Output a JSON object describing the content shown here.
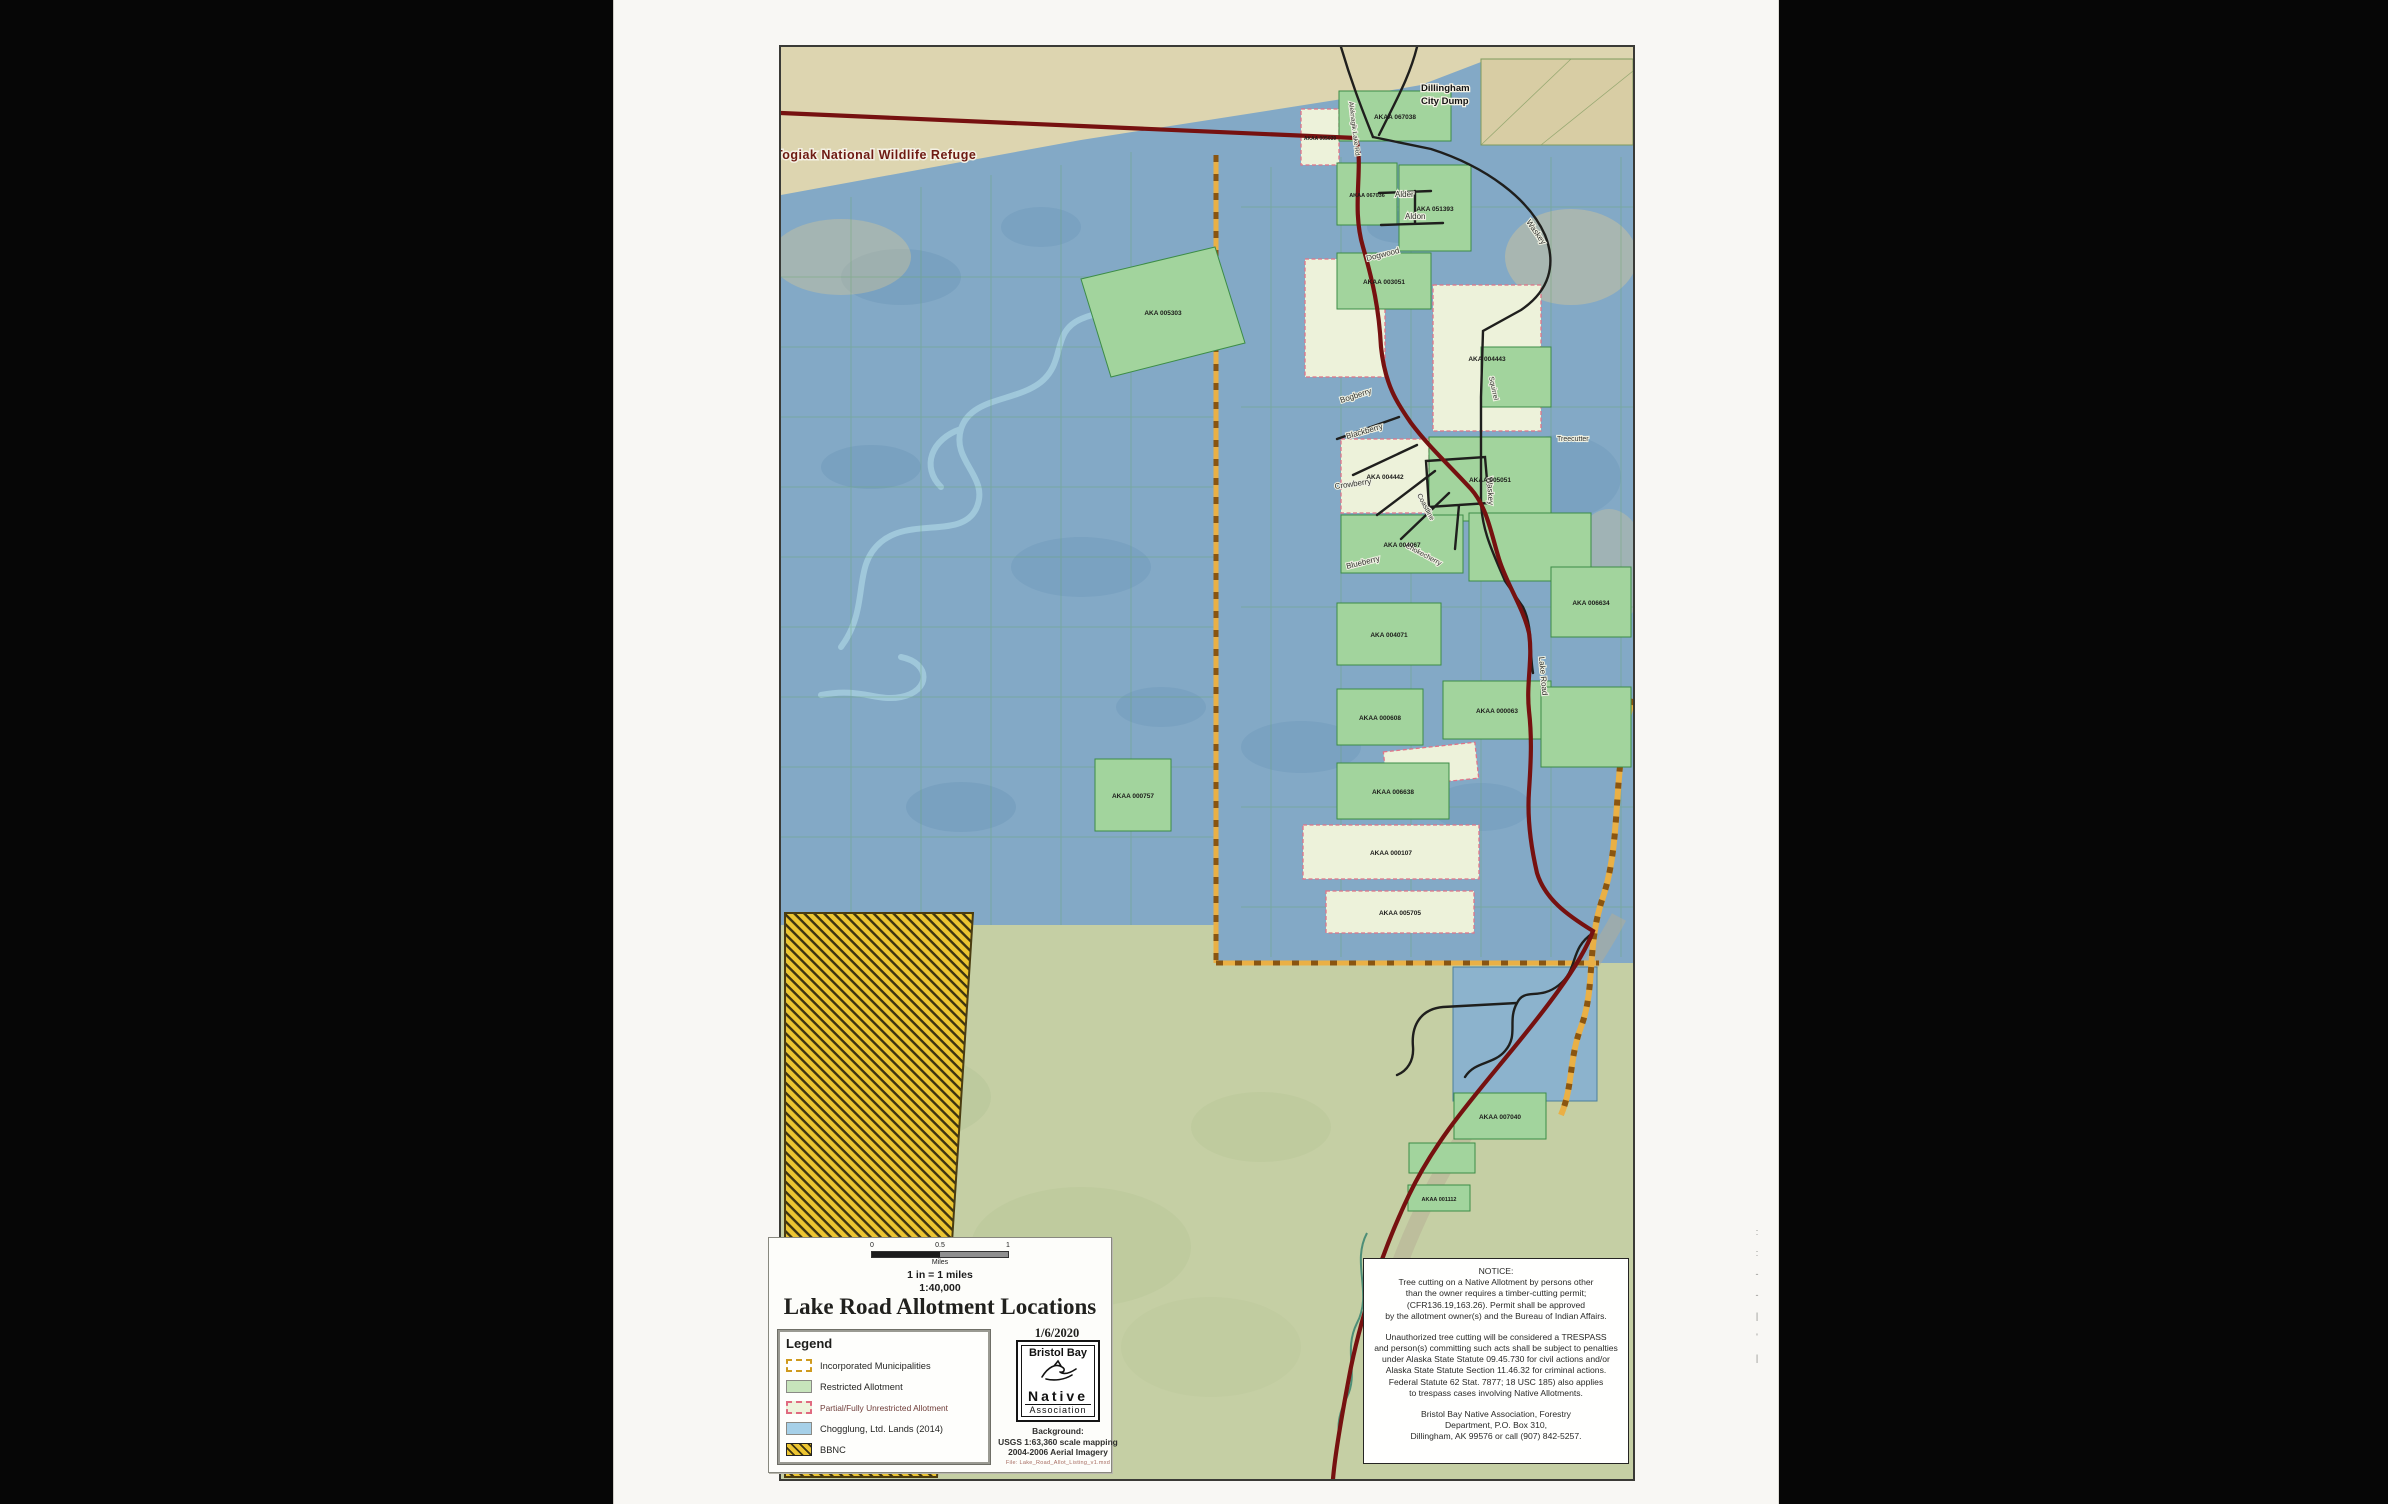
{
  "map": {
    "refuge_label": "Togiak National Wildlife Refuge",
    "dump_label_line1": "Dillingham",
    "dump_label_line2": "City Dump",
    "road_labels": {
      "aleknagik": "Aleknagik Lake Rd",
      "alder": "Alder",
      "aldon": "Aldon",
      "waskey": "Waskey",
      "waskey2": "Waskey",
      "dogwood": "Dogwood",
      "bogberry": "Bogberry",
      "blackberry": "Blackberry",
      "crowberry": "Crowberry",
      "blueberry": "Blueberry",
      "chokecherry": "Chokecherry",
      "coastline": "Coastline",
      "squirrel": "Squirrel",
      "treecutter": "Treecutter",
      "lake_road": "Lake Road"
    },
    "parcels": [
      "AKAA 067038",
      "AKAA 067036",
      "AKA 051393",
      "AKAA 003051",
      "AKA 005303",
      "AKA 004443",
      "AKAA 005051",
      "AKA 004442",
      "AKA 004067",
      "AKA 006634",
      "AKA 004071",
      "AKAA 000608",
      "AKAA 000757",
      "AKAA 006638",
      "AKAA 000107",
      "AKAA 005705",
      "AKAA 007040",
      "AKAA 001112",
      "AKAA 000063",
      "AKAA 005039"
    ],
    "colors": {
      "chogglung_blue": "#83a9c6",
      "restricted_green": "#a2d49d",
      "unrestricted_cream": "#edf2da",
      "bbnc_yellow": "#ecc531",
      "boundary_maroon": "#761110",
      "municipal_orange": "#eab045"
    }
  },
  "title_block": {
    "scale": {
      "ticks": [
        "0",
        "0.5",
        "1"
      ],
      "unit": "Miles",
      "equiv": "1 in = 1 miles",
      "ratio": "1:40,000"
    },
    "title": "Lake Road Allotment Locations",
    "date": "1/6/2020",
    "logo": {
      "line1": "Bristol Bay",
      "line2": "Native",
      "line3": "Association"
    },
    "background_note": "Background:\nUSGS 1:63,360 scale mapping\n2004-2006 Aerial Imagery",
    "file_note": "File: Lake_Road_Allot_Listing_v1.mxd"
  },
  "legend": {
    "heading": "Legend",
    "items": [
      {
        "label": "Incorporated Municipalities"
      },
      {
        "label": "Restricted Allotment"
      },
      {
        "label": "Partial/Fully Unrestricted Allotment"
      },
      {
        "label": "Chogglung, Ltd. Lands (2014)"
      },
      {
        "label": "BBNC"
      }
    ]
  },
  "notice": {
    "para1": "NOTICE:\nTree cutting on a Native Allotment by persons other\nthan the owner requires a timber-cutting permit;\n(CFR136.19,163.26). Permit shall be approved\nby the allotment owner(s) and the Bureau of Indian Affairs.",
    "para2": "Unauthorized tree cutting will be  considered a TRESPASS\nand person(s) committing such acts shall be subject to penalties\nunder Alaska State Statute 09.45.730 for civil actions and/or\nAlaska State Statute Section 11.46.32 for criminal actions.\nFederal Statute 62 Stat. 7877; 18 USC 185) also applies\nto trespass cases involving Native Allotments.",
    "para3": "Bristol Bay Native Association, Forestry\nDepartment, P.O. Box 310,\nDillingham, AK 99576 or call (907) 842-5257."
  },
  "margin_marks": [
    ":",
    ":",
    "-",
    "-",
    "|",
    "'",
    "|"
  ]
}
